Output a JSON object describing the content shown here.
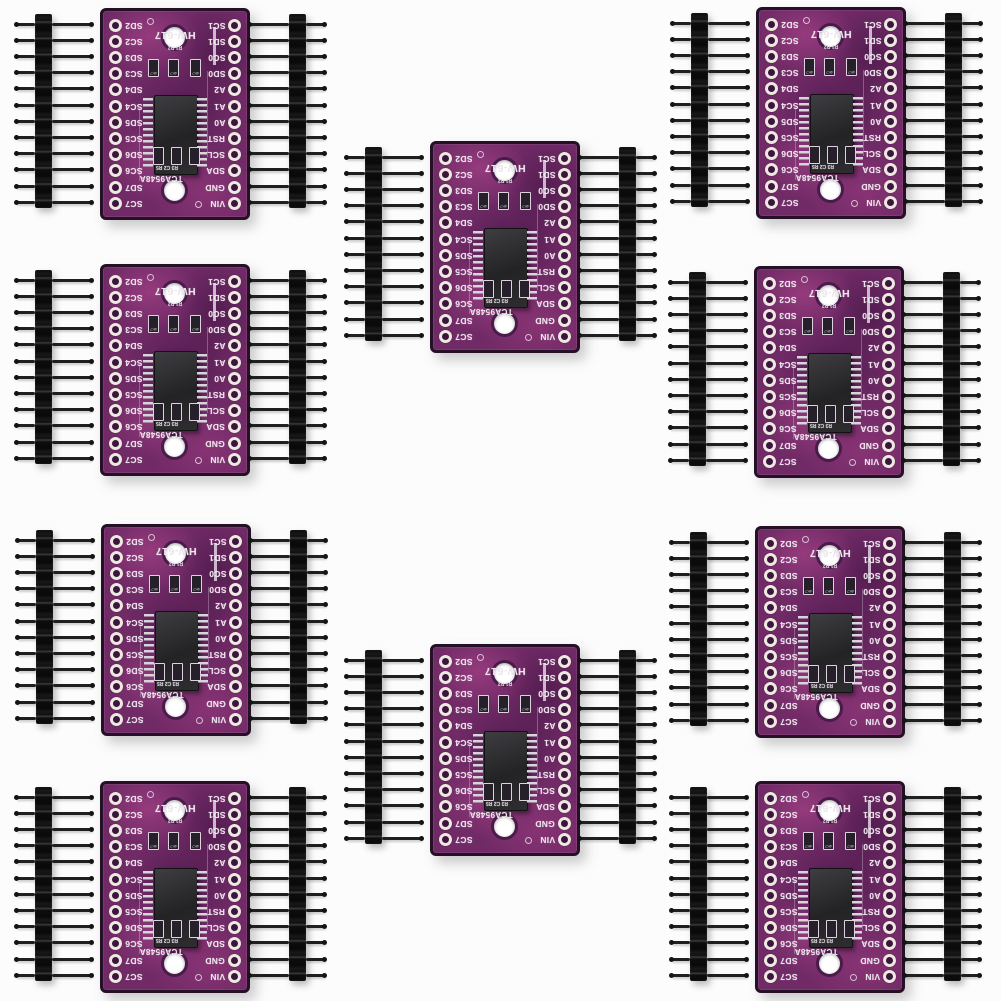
{
  "meta": {
    "background": "#fcfcfc"
  },
  "board": {
    "model": "HW-617",
    "chip_label": "TCA9548A",
    "left_pins": [
      "SD2",
      "SC2",
      "SD3",
      "SC3",
      "SD4",
      "SC4",
      "SD5",
      "SC5",
      "SD6",
      "SC6",
      "SD7",
      "SC7"
    ],
    "right_pins": [
      "SC1",
      "SD1",
      "SC0",
      "SD0",
      "A2",
      "A1",
      "A0",
      "RST",
      "SCL",
      "SDA",
      "GND",
      "VIN"
    ],
    "top_refs": "R1 R2",
    "bottom_refs": "R3 C2 R5",
    "resistor_value": "4K7",
    "colors": {
      "pcb": "#702a66",
      "pcb_bright": "#a1477f",
      "pcb_dark": "#3c1140",
      "edge": "#251027",
      "silk": "#ece4ec",
      "pad": "#efe8e2",
      "chip": "#28282a",
      "lead": "#d5d5da",
      "header_plastic": "#111111",
      "pin_metal": "#1f1f1f",
      "background": "#fcfcfc"
    }
  },
  "layout": {
    "canvas": {
      "w": 1001,
      "h": 1001
    },
    "board": {
      "w": 144,
      "h": 206,
      "rotated_180": true
    },
    "pin_pitch": 16.2,
    "row_first_center_y": 14,
    "header": {
      "pins": 12,
      "plastic_w": 17,
      "plastic_h": 194,
      "top_offset": 6,
      "offset_left": -65,
      "offset_right": 189,
      "long_pin": 40,
      "short_pin": 19
    },
    "groups": [
      {
        "x": 100,
        "y": 8
      },
      {
        "x": 100,
        "y": 264
      },
      {
        "x": 101,
        "y": 524
      },
      {
        "x": 100,
        "y": 781
      },
      {
        "x": 430,
        "y": 141
      },
      {
        "x": 430,
        "y": 644
      },
      {
        "x": 756,
        "y": 7
      },
      {
        "x": 754,
        "y": 266
      },
      {
        "x": 755,
        "y": 526
      },
      {
        "x": 755,
        "y": 781
      }
    ]
  }
}
